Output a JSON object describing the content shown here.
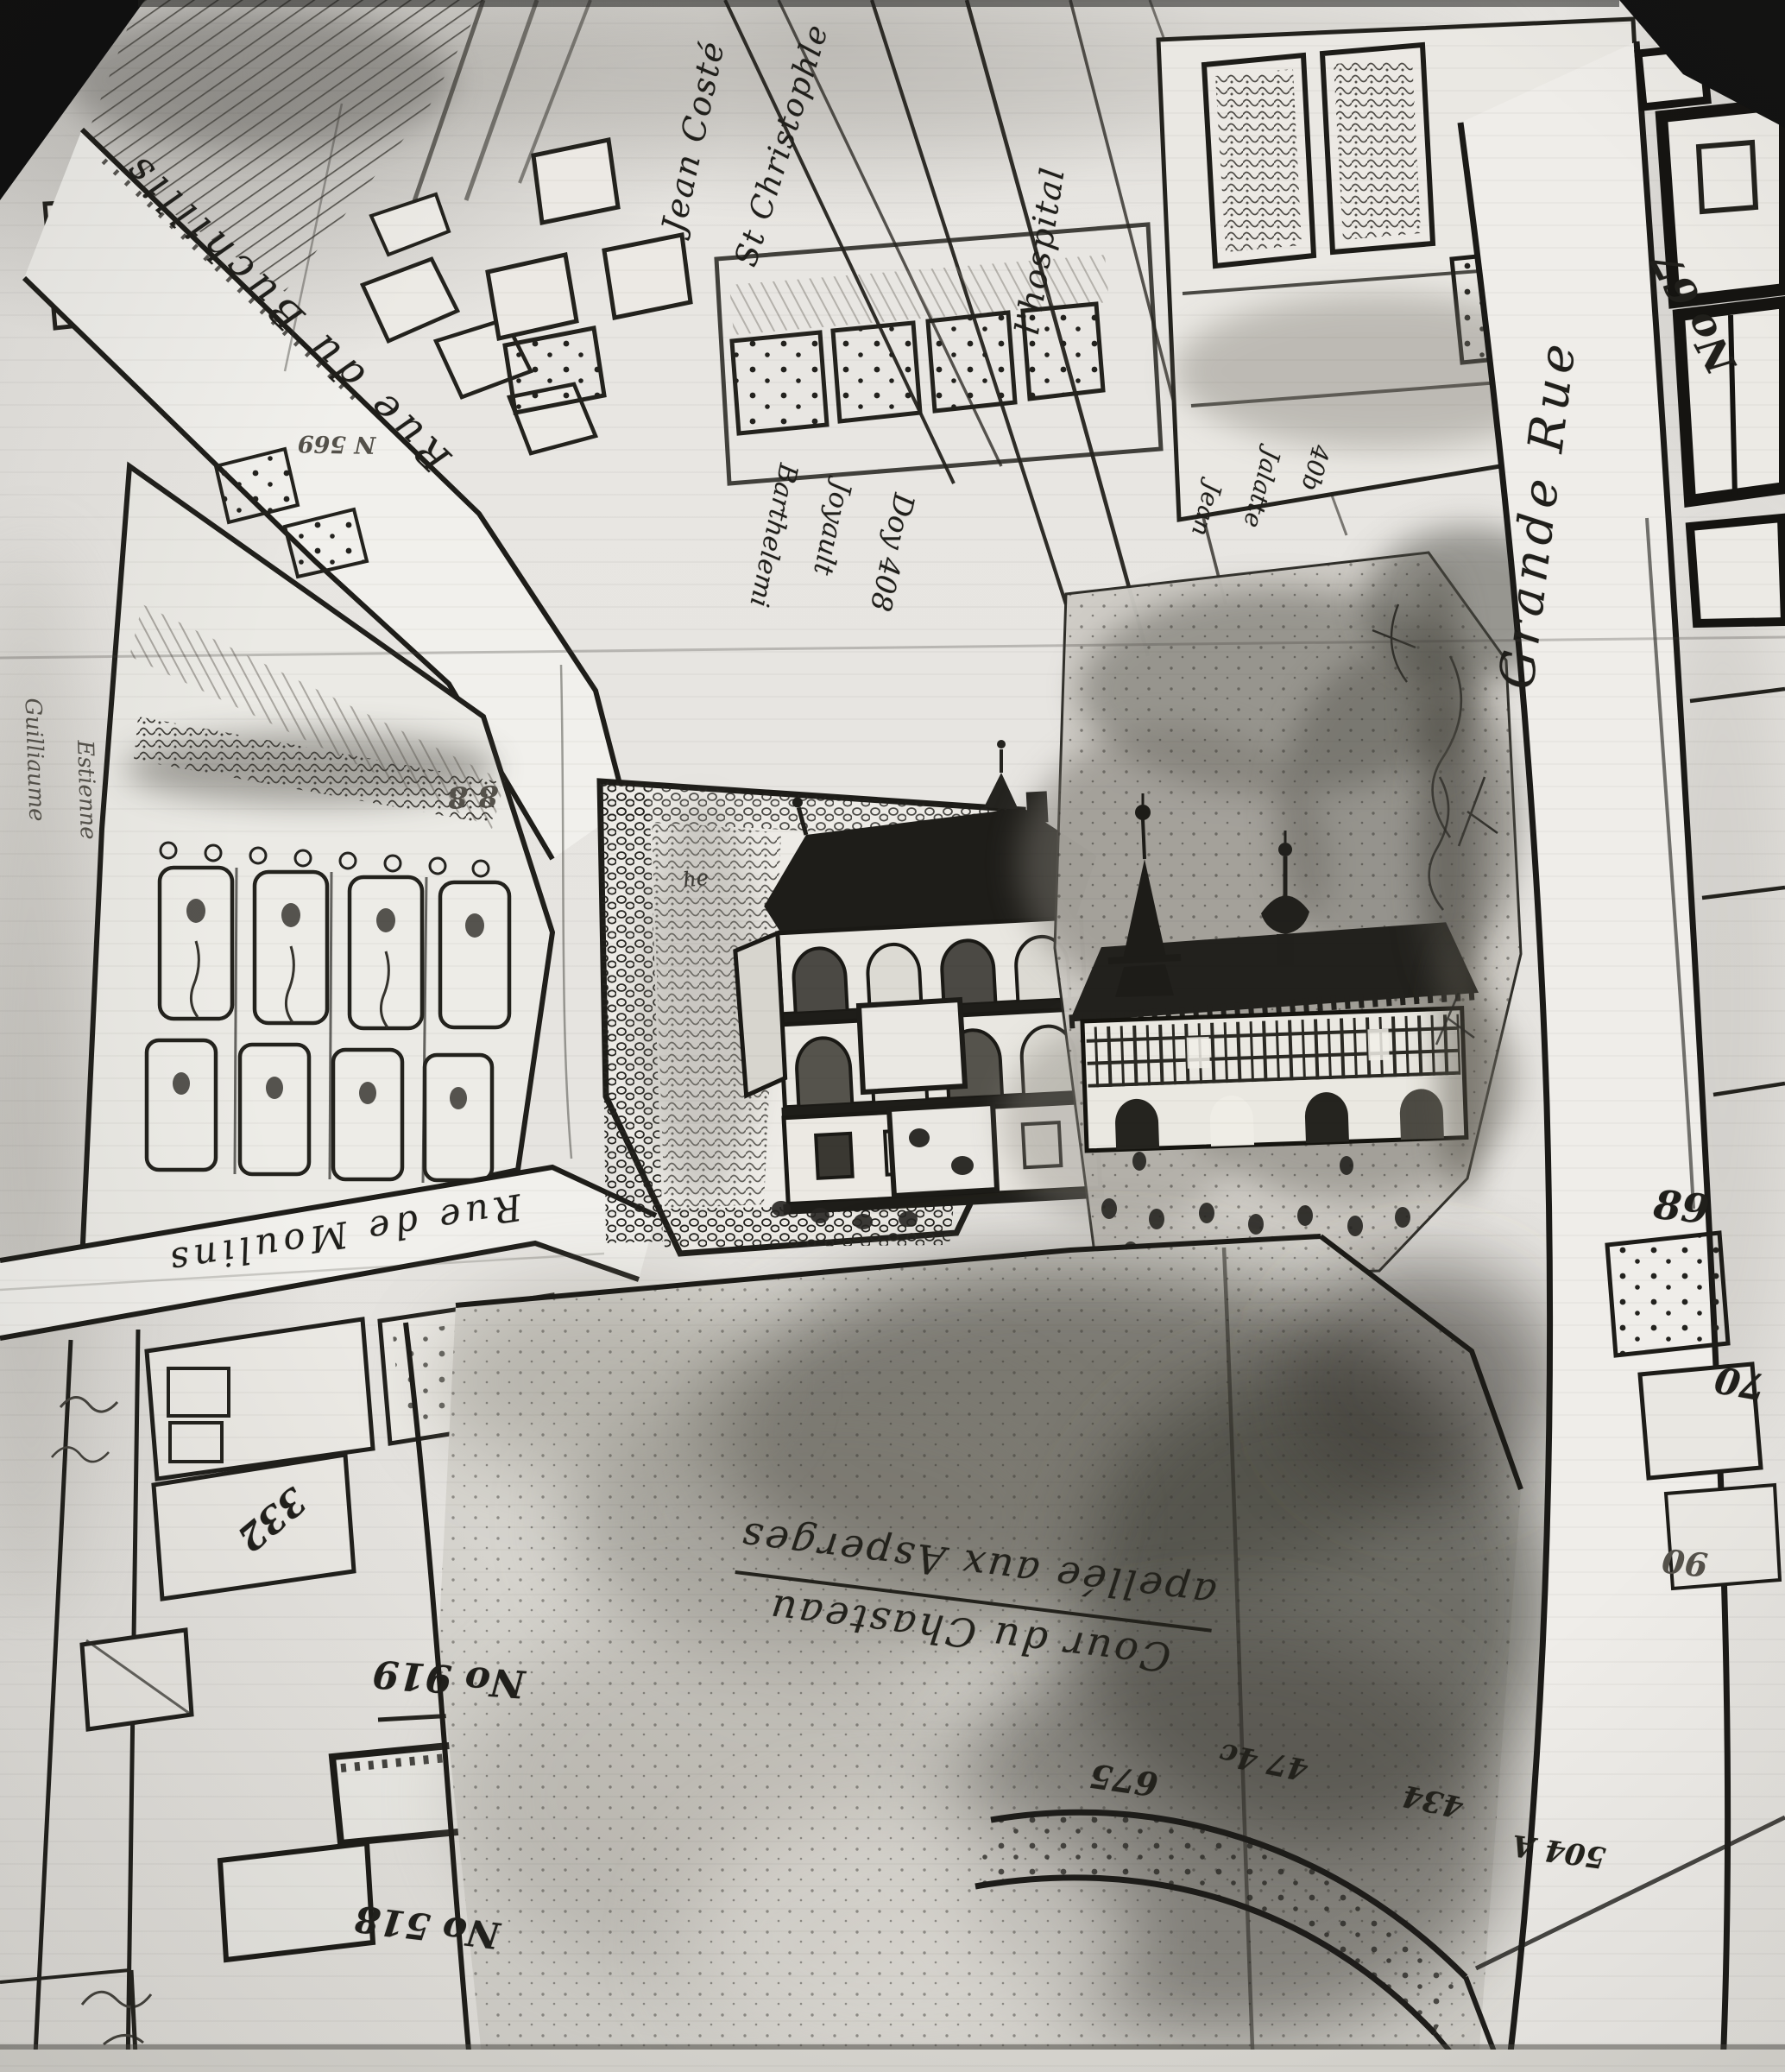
{
  "palette": {
    "paper": "#e7e5e1",
    "ink": "#1d1c18",
    "smudge": "#6f6c65",
    "photo_black": "#101010"
  },
  "labels": {
    "streets": {
      "buchillis": "Rue du Buchillis",
      "moulins": "Rue de Moulins",
      "grande_rue": "Grande Rue"
    },
    "places": {
      "cour_line1": "Cour du Chasteau",
      "cour_line2": "apellée aux Asperges",
      "he": "he"
    },
    "names": {
      "jean_coste": "Jean Costé",
      "st_christophle": "St Christophle",
      "hospital": "l'hospital",
      "barthelemi": "Barthelemi",
      "joyault": "Joyault",
      "doy": "Doy 408",
      "jean": "Jean",
      "jalatte": "Jalatte",
      "n40b": "40b",
      "guilliaume": "Guilliaume",
      "estienne": "Estienne"
    },
    "numbers": {
      "n67": "No 67",
      "n89": "89",
      "n70": "70",
      "n90": "90",
      "n919": "No 919",
      "n332": "332",
      "n518": "No 518",
      "n569": "N 569",
      "n88": "8 8",
      "n675": "675",
      "n474": "47 4c",
      "n434": "434",
      "n504": "504 A"
    }
  }
}
